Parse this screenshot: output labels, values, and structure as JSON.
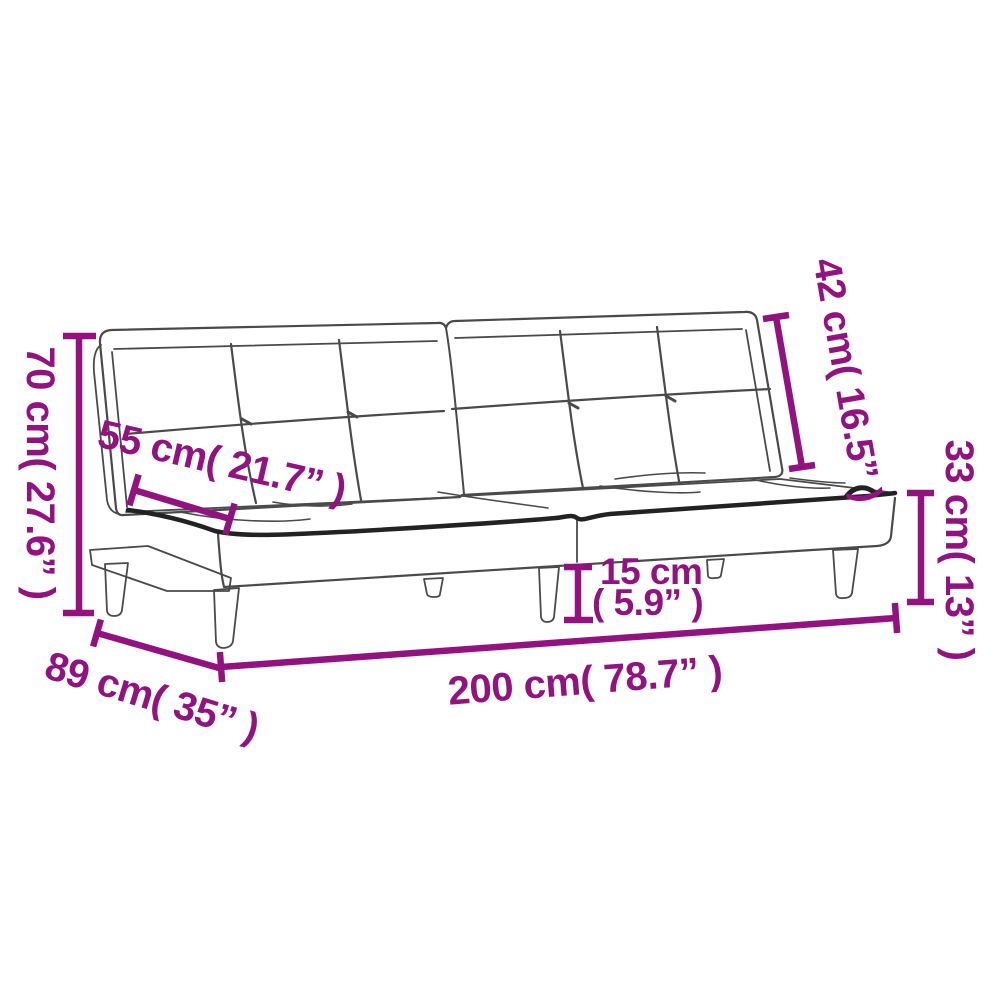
{
  "page": {
    "background": "#ffffff"
  },
  "diagram": {
    "title": "Sofa bed dimension diagram",
    "product": "sofa-bed",
    "accent_color": "#921380",
    "sketch_color": "#4a4a4a",
    "labels": {
      "overall_height": "70 cm( 27.6” )",
      "seat_depth": "55 cm( 21.7” )",
      "backrest_height": "42 cm( 16.5” )",
      "seat_height": "33 cm( 13” )",
      "clearance_value": "15 cm",
      "clearance_inches": "( 5.9” )",
      "overall_width": "200 cm( 78.7” )",
      "overall_depth": "89 cm( 35” )"
    }
  }
}
